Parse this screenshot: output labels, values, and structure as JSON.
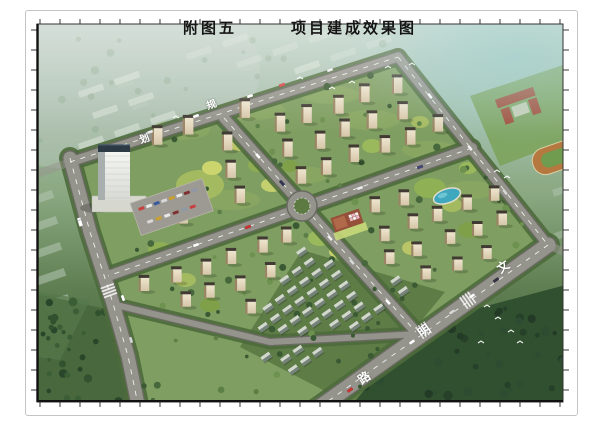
{
  "figure": {
    "title_prefix": "附图五",
    "title_main": "项目建成效果图"
  },
  "road_labels": [
    {
      "char": "规",
      "x": 213,
      "y": 103,
      "rot": -20,
      "size": 10
    },
    {
      "char": "划",
      "x": 146,
      "y": 137,
      "rot": -20,
      "size": 10
    },
    {
      "char": "文",
      "x": 504,
      "y": 265,
      "rot": -35,
      "size": 12
    },
    {
      "char": "明",
      "x": 425,
      "y": 329,
      "rot": -35,
      "size": 12
    },
    {
      "char": "路",
      "x": 365,
      "y": 376,
      "rot": -35,
      "size": 12
    }
  ],
  "colors": {
    "mist_teal": "#9ecdc9",
    "haze_green": "#bccfc3",
    "site_green": "#7f9e61",
    "road_gray": "#95948c",
    "building_facade": "#e9dfc8",
    "building_roof": "#3f3a33",
    "dark_foliage": "#33512e",
    "landscape_accent": "#b9c566",
    "water": "#3fa8bf",
    "school_red": "#a34a36",
    "track_brown": "#b5793f",
    "frame_border": "#c4c4c4"
  }
}
